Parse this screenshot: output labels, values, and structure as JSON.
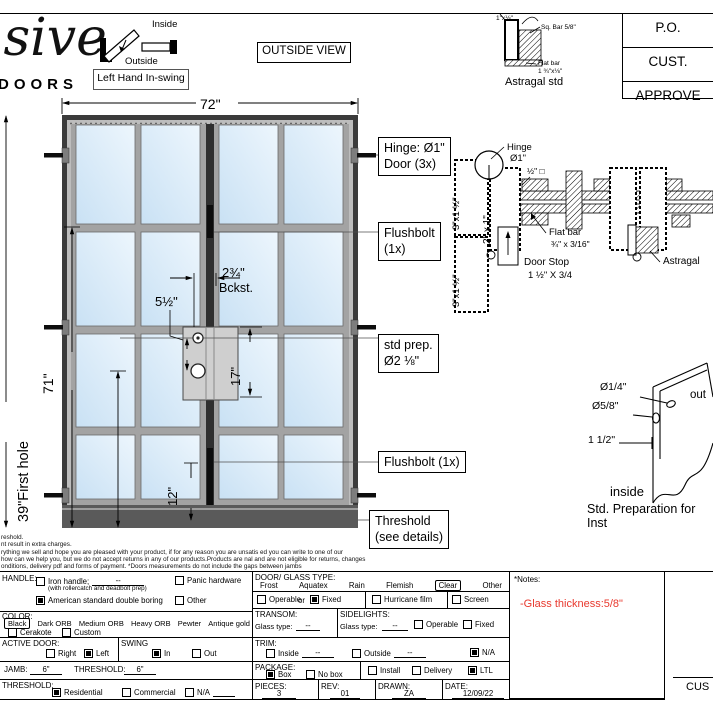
{
  "header": {
    "logo": {
      "script": "usive",
      "sub": "DOORS"
    },
    "swing": {
      "inside": "Inside",
      "outside": "Outside",
      "label": "Left Hand In-swing"
    },
    "view_label": "OUTSIDE VIEW",
    "astragal": {
      "dim": "1\"x⅛\"",
      "sq_bar": "Sq. Bar 5/8\"",
      "flat1": "Flat bar",
      "flat2": "1 ¾\"x⅛\"",
      "caption": "Astragal std"
    },
    "approvals": [
      "P.O.",
      "CUST.",
      "APPROVE"
    ]
  },
  "elevation": {
    "dims": {
      "width": "72\"",
      "height": "96\"",
      "h71": "71\"",
      "first_hole": "39\"First hole",
      "backset": "2¾\"",
      "backset_label": "Bckst.",
      "spacing": "5½\"",
      "h17": "17\"",
      "h12": "12\""
    },
    "callouts": {
      "hinge_l1": "Hinge: Ø1\"",
      "hinge_l2": "Door (3x)",
      "fb_top_l1": "Flushbolt",
      "fb_top_l2": "(1x)",
      "std_l1": "std prep.",
      "std_l2": "Ø2 ⅛\"",
      "fb_bottom": "Flushbolt (1x)",
      "th_l1": "Threshold",
      "th_l2": "(see details)"
    }
  },
  "section": {
    "hinge_l1": "Hinge",
    "hinge_l2": "Ø1\"",
    "sq_bar": "½\" □",
    "jamb1": "3\"x1 ½\"",
    "jamb2": "3\"x1 ½\"",
    "stile": "2\" x 1\"",
    "flat1": "Flat bar",
    "flat2": "¾\" x 3/16\"",
    "stop1": "Door Stop",
    "stop2": "1 ½\" X 3/4",
    "astragal": "Astragal"
  },
  "threshold_detail": {
    "hole_small": "Ø1/4\"",
    "hole_big": "Ø5/8\"",
    "offset": "1 1/2\"",
    "outside": "out",
    "inside": "inside",
    "caption": "Std. Preparation for Inst"
  },
  "disclaimer": {
    "lines": [
      "reshold.",
      "nt result in extra charges.",
      "rything we sell and hope you are pleased with your product, if for any reason you are unsatis ed you can write to one of our",
      "how can we help you, but we do not accept returns in any of our products.Products are  nal and are not eligible for returns, changes",
      "onditions, delivery pdf and forms of payment. *Doors measurements do not include the gaps between jambs"
    ]
  },
  "form": {
    "handle": {
      "label": "HANDLE:",
      "iron": {
        "label": "Iron handle;",
        "value": "--",
        "checked": false,
        "note": "(with rollercatch and deadbolt prep)"
      },
      "american": {
        "label": "American standard double boring",
        "checked": true
      },
      "panic": {
        "label": "Panic hardware",
        "checked": false
      },
      "other": {
        "label": "Other",
        "checked": false
      }
    },
    "color": {
      "label": "COLOR:",
      "selected": "Black",
      "options": [
        "Black",
        "Dark ORB",
        "Medium ORB",
        "Heavy ORB",
        "Pewter",
        "Antique gold"
      ],
      "cerakote": {
        "label": "Cerakote",
        "checked": false
      },
      "custom": {
        "label": "Custom",
        "checked": false
      }
    },
    "active_door": {
      "label": "ACTIVE DOOR:",
      "right": {
        "label": "Right",
        "checked": false
      },
      "left": {
        "label": "Left",
        "checked": true
      }
    },
    "swing": {
      "label": "SWING",
      "in": {
        "label": "In",
        "checked": true
      },
      "out": {
        "label": "Out",
        "checked": false
      }
    },
    "jamb": {
      "label": "JAMB:",
      "value": "6\""
    },
    "threshold_dim": {
      "label": "THRESHOLD:",
      "value": "6\""
    },
    "threshold": {
      "label": "THRESHOLD:",
      "residential": {
        "label": "Residential",
        "checked": true
      },
      "commercial": {
        "label": "Commercial",
        "checked": false
      },
      "na": {
        "label": "N/A",
        "checked": false
      }
    },
    "glass": {
      "label": "DOOR/ GLASS TYPE:",
      "selected": "Clear",
      "types": [
        "Frost",
        "Aquatex",
        "Rain",
        "Flemish",
        "Clear",
        "Other"
      ],
      "operable": {
        "label": "Operable",
        "checked": false
      },
      "or_label": "or",
      "fixed": {
        "label": "Fixed",
        "checked": true
      },
      "hurricane": {
        "label": "Hurricane film",
        "checked": false
      },
      "screen": {
        "label": "Screen",
        "checked": false
      }
    },
    "transom": {
      "label": "TRANSOM:",
      "glass_label": "Glass type:",
      "value": "--"
    },
    "sidelights": {
      "label": "SIDELIGHTS:",
      "glass_label": "Glass type:",
      "value": "--",
      "operable": {
        "label": "Operable",
        "checked": false
      },
      "fixed": {
        "label": "Fixed",
        "checked": false
      }
    },
    "trim": {
      "label": "TRIM:",
      "inside": {
        "label": "Inside",
        "value": "--",
        "checked": false
      },
      "outside": {
        "label": "Outside",
        "value": "--",
        "checked": false
      },
      "na": {
        "label": "N/A",
        "checked": true
      }
    },
    "package": {
      "label": "PACKAGE:",
      "box": {
        "label": "Box",
        "checked": true
      },
      "nobox": {
        "label": "No box",
        "checked": false
      },
      "install": {
        "label": "Install",
        "checked": false
      },
      "delivery": {
        "label": "Delivery",
        "checked": false
      },
      "ltl": {
        "label": "LTL",
        "checked": true
      }
    },
    "pieces": {
      "label": "PIECES:",
      "value": "3"
    },
    "rev": {
      "label": "REV:",
      "value": "01"
    },
    "drawn": {
      "label": "DRAWN:",
      "value": "ZA"
    },
    "date": {
      "label": "DATE:",
      "value": "12/09/22"
    },
    "notes": {
      "label": "*Notes:",
      "text": "-Glass thickness:5/8\""
    },
    "signature": "CUS"
  },
  "colors": {
    "note_red": "#e8392e",
    "glass_light": "#edf6fd",
    "glass_dark": "#c9e1f4",
    "frame_dark": "#3b3b3b"
  }
}
